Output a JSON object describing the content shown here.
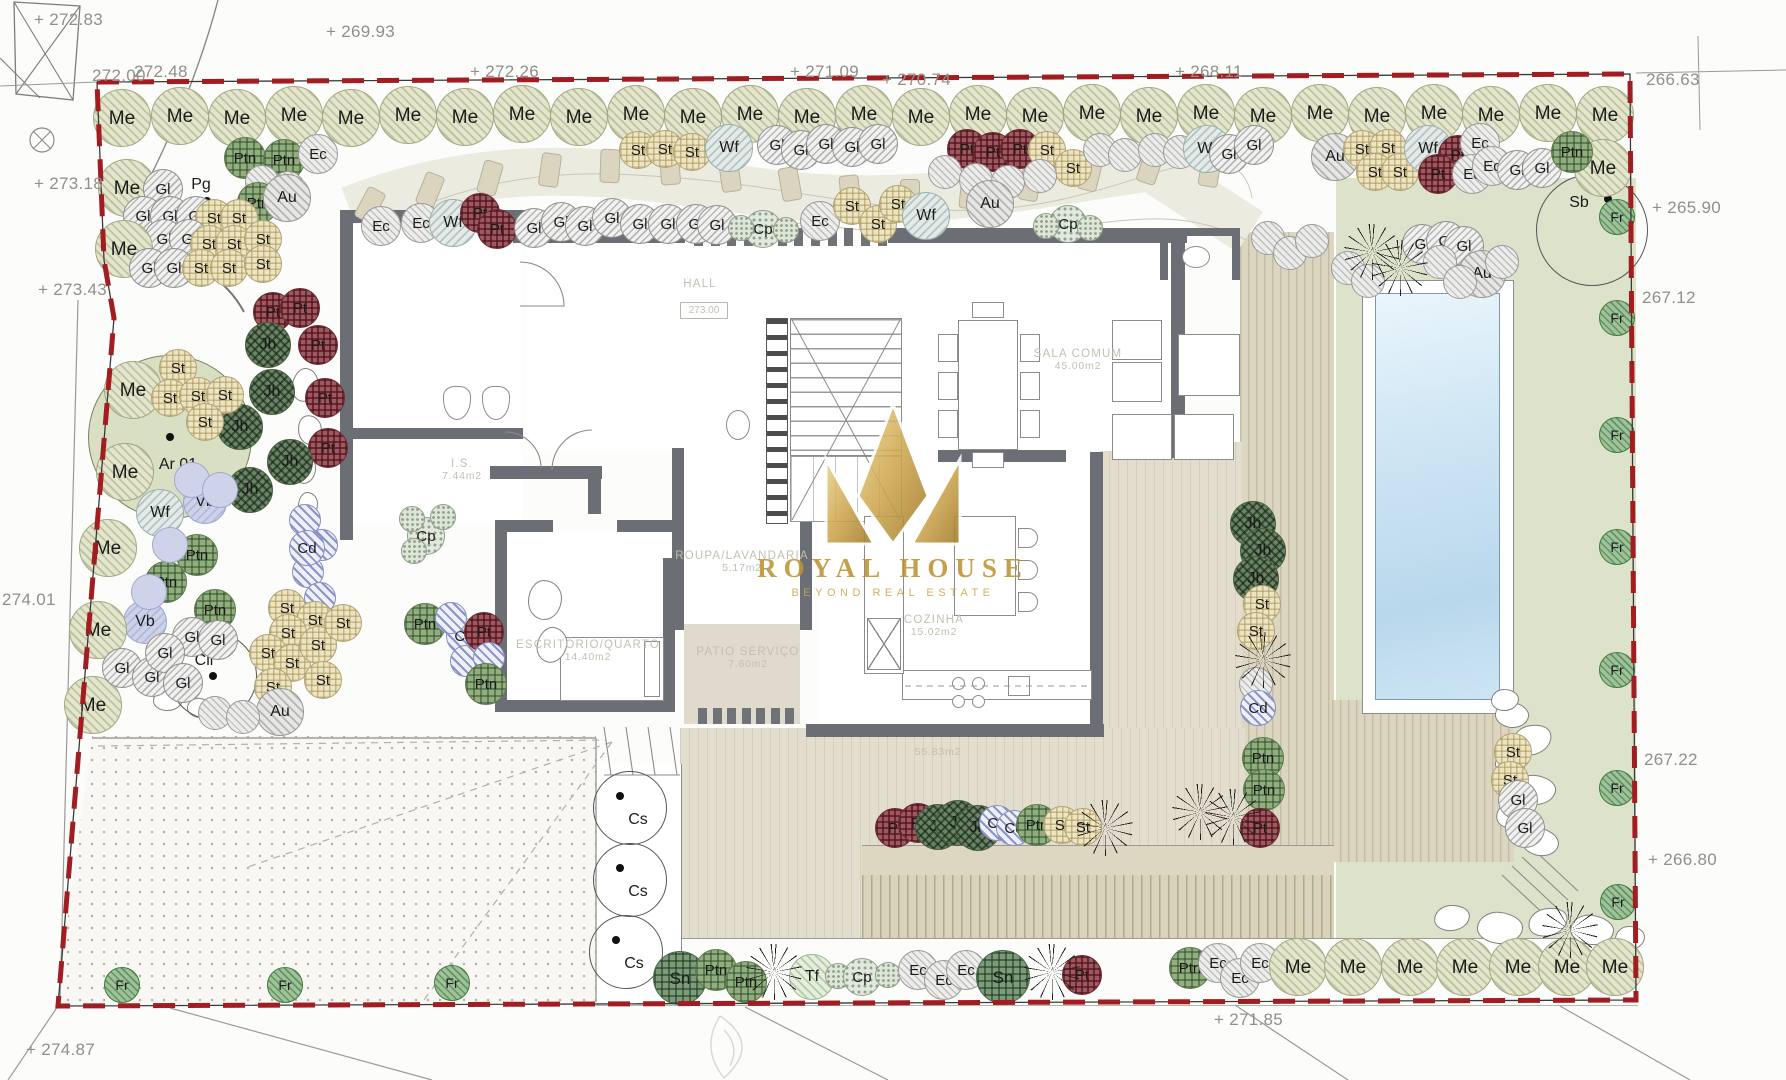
{
  "canvas": {
    "w": 1786,
    "h": 1080
  },
  "watermark": {
    "title": "ROYAL HOUSE",
    "subtitle": "BEYOND REAL ESTATE"
  },
  "rooms": [
    {
      "name": "HALL",
      "area": "",
      "level": "273.00",
      "x": 700,
      "y": 284
    },
    {
      "name": "I.S.",
      "area": "7.44m2",
      "x": 462,
      "y": 470
    },
    {
      "name": "SALA COMUM",
      "area": "45.00m2",
      "x": 1078,
      "y": 360
    },
    {
      "name": "COZINHA",
      "area": "15.02m2",
      "x": 934,
      "y": 626
    },
    {
      "name": "ROUPA/LAVANDARIA",
      "area": "5.17m2",
      "x": 742,
      "y": 562
    },
    {
      "name": "ESCRITÓRIO/QUARTO",
      "area": "14.40m2",
      "x": 588,
      "y": 651
    },
    {
      "name": "PATIO SERVIÇO",
      "area": "7.60m2",
      "x": 748,
      "y": 658
    },
    {
      "name": "",
      "area": "55.83m2",
      "x": 938,
      "y": 752
    }
  ],
  "elevations": [
    {
      "v": "272.83",
      "x": 34,
      "y": 10,
      "plus": true
    },
    {
      "v": "269.93",
      "x": 326,
      "y": 22,
      "plus": true
    },
    {
      "v": "272.00",
      "x": 92,
      "y": 66,
      "plus": false
    },
    {
      "v": "272.48",
      "x": 134,
      "y": 62,
      "plus": false
    },
    {
      "v": "272.26",
      "x": 470,
      "y": 62,
      "plus": true
    },
    {
      "v": "271.09",
      "x": 790,
      "y": 62,
      "plus": true
    },
    {
      "v": "270.74",
      "x": 882,
      "y": 70,
      "plus": true
    },
    {
      "v": "268.11",
      "x": 1175,
      "y": 62,
      "plus": true
    },
    {
      "v": "266.63",
      "x": 1646,
      "y": 70,
      "plus": false
    },
    {
      "v": "265.90",
      "x": 1652,
      "y": 198,
      "plus": true
    },
    {
      "v": "267.12",
      "x": 1642,
      "y": 288,
      "plus": false
    },
    {
      "v": "267.22",
      "x": 1644,
      "y": 750,
      "plus": false
    },
    {
      "v": "266.80",
      "x": 1648,
      "y": 850,
      "plus": true
    },
    {
      "v": "271.85",
      "x": 1214,
      "y": 1010,
      "plus": true
    },
    {
      "v": "274.87",
      "x": 26,
      "y": 1040,
      "plus": true
    },
    {
      "v": "273.18",
      "x": 34,
      "y": 174,
      "plus": true
    },
    {
      "v": "273.43",
      "x": 38,
      "y": 280,
      "plus": true
    },
    {
      "v": "274.01",
      "x": 2,
      "y": 590,
      "plus": false
    }
  ],
  "special_trees": [
    {
      "label": "Ar 01",
      "x": 170,
      "y": 437,
      "r": 82,
      "kind": "fill",
      "dot": [
        0,
        0
      ],
      "lbl": [
        8,
        28
      ]
    },
    {
      "label": "Pg",
      "x": 207,
      "y": 201,
      "r": 0,
      "kind": "point",
      "dot": [
        0,
        0
      ],
      "lbl": [
        -6,
        -16
      ]
    },
    {
      "label": "Cli",
      "x": 213,
      "y": 676,
      "r": 44,
      "kind": "outline",
      "dot": [
        0,
        0
      ],
      "lbl": [
        -9,
        -15
      ]
    },
    {
      "label": "Sb",
      "x": 1592,
      "y": 230,
      "r": 56,
      "kind": "outline",
      "dot": [
        16,
        -31
      ],
      "lbl": [
        -13,
        -27
      ]
    },
    {
      "label": "Cs",
      "x": 630,
      "y": 808,
      "r": 37,
      "kind": "outline",
      "dot": [
        -10,
        -12
      ],
      "lbl": [
        8,
        12
      ]
    },
    {
      "label": "Cs",
      "x": 630,
      "y": 880,
      "r": 37,
      "kind": "outline",
      "dot": [
        -10,
        -12
      ],
      "lbl": [
        8,
        12
      ]
    },
    {
      "label": "Cs",
      "x": 626,
      "y": 952,
      "r": 37,
      "kind": "outline",
      "dot": [
        -10,
        -12
      ],
      "lbl": [
        8,
        12
      ]
    }
  ],
  "grasses": [
    [
      1372,
      252
    ],
    [
      1400,
      268
    ],
    [
      1263,
      660
    ],
    [
      1233,
      817
    ],
    [
      1200,
      812
    ],
    [
      774,
      972
    ],
    [
      1052,
      972
    ],
    [
      1570,
      930
    ],
    [
      1105,
      828
    ]
  ],
  "plants": [
    [
      "Me",
      122,
      118
    ],
    [
      "Me",
      180,
      116
    ],
    [
      "Me",
      237,
      118
    ],
    [
      "Me",
      294,
      115
    ],
    [
      "Me",
      351,
      118
    ],
    [
      "Me",
      408,
      115
    ],
    [
      "Me",
      465,
      117
    ],
    [
      "Me",
      522,
      114
    ],
    [
      "Me",
      579,
      117
    ],
    [
      "Me",
      636,
      114
    ],
    [
      "Me",
      693,
      117
    ],
    [
      "Me",
      750,
      114
    ],
    [
      "Me",
      807,
      117
    ],
    [
      "Me",
      864,
      114
    ],
    [
      "Me",
      921,
      117
    ],
    [
      "Me",
      978,
      114
    ],
    [
      "Me",
      1035,
      116
    ],
    [
      "Me",
      1092,
      113
    ],
    [
      "Me",
      1149,
      116
    ],
    [
      "Me",
      1206,
      113
    ],
    [
      "Me",
      1263,
      116
    ],
    [
      "Me",
      1320,
      113
    ],
    [
      "Me",
      1377,
      116
    ],
    [
      "Me",
      1434,
      113
    ],
    [
      "Me",
      1491,
      115
    ],
    [
      "Me",
      1548,
      113
    ],
    [
      "Me",
      1605,
      115
    ],
    [
      "Me",
      1603,
      168
    ],
    [
      "St",
      638,
      150
    ],
    [
      "St",
      665,
      149
    ],
    [
      "St",
      692,
      152
    ],
    [
      "Wf",
      729,
      148
    ],
    [
      "Gl",
      777,
      145
    ],
    [
      "Gl",
      801,
      150
    ],
    [
      "Gl",
      826,
      144
    ],
    [
      "Gl",
      852,
      147
    ],
    [
      "Gl",
      878,
      144
    ],
    [
      "Pt",
      967,
      149
    ],
    [
      "Pt",
      993,
      152
    ],
    [
      "Pt",
      1020,
      149
    ],
    [
      "St",
      1047,
      150
    ],
    [
      "St",
      1073,
      168
    ],
    [
      "Gx",
      945,
      172
    ],
    [
      "Gx",
      976,
      180
    ],
    [
      "Gx",
      1008,
      182
    ],
    [
      "Gx",
      1040,
      176
    ],
    [
      "Gx",
      1100,
      150
    ],
    [
      "Gx",
      1125,
      155
    ],
    [
      "Gx",
      1155,
      150
    ],
    [
      "Gx",
      1180,
      152
    ],
    [
      "Wf",
      1207,
      149
    ],
    [
      "Gl",
      1229,
      154
    ],
    [
      "Gl",
      1254,
      145
    ],
    [
      "Au",
      1335,
      157
    ],
    [
      "St",
      1362,
      149
    ],
    [
      "St",
      1388,
      148
    ],
    [
      "St",
      1375,
      172
    ],
    [
      "St",
      1400,
      172
    ],
    [
      "Wf",
      1428,
      149
    ],
    [
      "Pt",
      1458,
      155
    ],
    [
      "Ec",
      1480,
      143
    ],
    [
      "Pt",
      1438,
      174
    ],
    [
      "Ec",
      1472,
      174
    ],
    [
      "Ec",
      1492,
      166
    ],
    [
      "Gl",
      1517,
      170
    ],
    [
      "Gl",
      1542,
      168
    ],
    [
      "Ptn",
      1572,
      152
    ],
    [
      "Ptn",
      245,
      158
    ],
    [
      "Ptn",
      284,
      160
    ],
    [
      "Gx",
      262,
      182
    ],
    [
      "Gx",
      288,
      188
    ],
    [
      "Ptn",
      258,
      203
    ],
    [
      "Au",
      287,
      198
    ],
    [
      "Me",
      127,
      188
    ],
    [
      "Gl",
      163,
      189
    ],
    [
      "Gl",
      143,
      216
    ],
    [
      "Gl",
      170,
      216
    ],
    [
      "Gl",
      196,
      216
    ],
    [
      "St",
      214,
      218
    ],
    [
      "St",
      239,
      218
    ],
    [
      "Gl",
      164,
      239
    ],
    [
      "Gl",
      189,
      239
    ],
    [
      "St",
      209,
      244
    ],
    [
      "St",
      234,
      244
    ],
    [
      "St",
      263,
      239
    ],
    [
      "Me",
      124,
      249
    ],
    [
      "Gl",
      149,
      268
    ],
    [
      "Gl",
      174,
      268
    ],
    [
      "St",
      201,
      268
    ],
    [
      "St",
      229,
      268
    ],
    [
      "St",
      263,
      264
    ],
    [
      "Ec",
      318,
      154
    ],
    [
      "Ec",
      381,
      226
    ],
    [
      "Ec",
      421,
      223
    ],
    [
      "Wf",
      453,
      223
    ],
    [
      "Pt",
      480,
      213
    ],
    [
      "Pt",
      497,
      229
    ],
    [
      "Gl",
      534,
      228
    ],
    [
      "Gl",
      561,
      222
    ],
    [
      "Gl",
      585,
      226
    ],
    [
      "Gl",
      612,
      218
    ],
    [
      "Gl",
      640,
      224
    ],
    [
      "Gl",
      668,
      224
    ],
    [
      "Gl",
      696,
      224
    ],
    [
      "Gl",
      717,
      225
    ],
    [
      "Cp",
      763,
      229
    ],
    [
      "Gg",
      741,
      228
    ],
    [
      "Gg",
      786,
      230
    ],
    [
      "Ec",
      820,
      221
    ],
    [
      "St",
      852,
      206
    ],
    [
      "St",
      878,
      224
    ],
    [
      "St",
      898,
      204
    ],
    [
      "Wf",
      926,
      216
    ],
    [
      "Au",
      990,
      204
    ],
    [
      "Cp",
      1068,
      224
    ],
    [
      "Gg",
      1046,
      226
    ],
    [
      "Gg",
      1090,
      228
    ],
    [
      "Gl",
      1422,
      244
    ],
    [
      "Gl",
      1446,
      241
    ],
    [
      "Gl",
      1464,
      246
    ],
    [
      "Au",
      1482,
      274
    ],
    [
      "Gx",
      1268,
      238
    ],
    [
      "Gx",
      1290,
      253
    ],
    [
      "Gx",
      1312,
      241
    ],
    [
      "Gx",
      1348,
      268
    ],
    [
      "Gx",
      1368,
      281
    ],
    [
      "Gx",
      1440,
      262
    ],
    [
      "Gx",
      1460,
      282
    ],
    [
      "Gx",
      1502,
      262
    ],
    [
      "Pt",
      273,
      312
    ],
    [
      "Pt",
      300,
      308
    ],
    [
      "Pt",
      318,
      345
    ],
    [
      "Pt",
      325,
      398
    ],
    [
      "Pt",
      328,
      448
    ],
    [
      "Jh",
      268,
      345
    ],
    [
      "Jh",
      272,
      392
    ],
    [
      "Jh",
      240,
      427
    ],
    [
      "Jh",
      250,
      490
    ],
    [
      "Jh",
      290,
      462
    ],
    [
      "Gb",
      305,
      520
    ],
    [
      "Gb",
      322,
      545
    ],
    [
      "Gb",
      308,
      572
    ],
    [
      "Gb",
      320,
      598
    ],
    [
      "Gb",
      306,
      622
    ],
    [
      "Cd",
      307,
      548
    ],
    [
      "Me",
      133,
      390
    ],
    [
      "St",
      178,
      368
    ],
    [
      "St",
      170,
      398
    ],
    [
      "St",
      198,
      396
    ],
    [
      "St",
      225,
      395
    ],
    [
      "St",
      205,
      422
    ],
    [
      "Me",
      125,
      472
    ],
    [
      "Wf",
      160,
      513
    ],
    [
      "Vb",
      205,
      502
    ],
    [
      "Gv",
      192,
      480
    ],
    [
      "Gv",
      220,
      490
    ],
    [
      "Me",
      108,
      548
    ],
    [
      "Ptn",
      197,
      555
    ],
    [
      "Ptn",
      166,
      582
    ],
    [
      "Ptn",
      215,
      610
    ],
    [
      "Vb",
      145,
      622
    ],
    [
      "Gv",
      170,
      545
    ],
    [
      "Gv",
      149,
      592
    ],
    [
      "Me",
      98,
      630
    ],
    [
      "Me",
      93,
      705
    ],
    [
      "Gl",
      192,
      637
    ],
    [
      "Gl",
      218,
      640
    ],
    [
      "Gl",
      122,
      668
    ],
    [
      "Gl",
      152,
      677
    ],
    [
      "Gl",
      165,
      653
    ],
    [
      "Gl",
      183,
      683
    ],
    [
      "St",
      287,
      608
    ],
    [
      "St",
      315,
      620
    ],
    [
      "St",
      288,
      633
    ],
    [
      "St",
      268,
      653
    ],
    [
      "St",
      292,
      663
    ],
    [
      "St",
      318,
      645
    ],
    [
      "St",
      323,
      680
    ],
    [
      "St",
      273,
      687
    ],
    [
      "St",
      343,
      623
    ],
    [
      "Au",
      280,
      712
    ],
    [
      "Gx",
      215,
      713
    ],
    [
      "Gx",
      243,
      717
    ],
    [
      "Cp",
      426,
      536
    ],
    [
      "Gg",
      412,
      519
    ],
    [
      "Gg",
      443,
      517
    ],
    [
      "Gg",
      414,
      551
    ],
    [
      "Ptn",
      425,
      624
    ],
    [
      "Cd",
      464,
      636
    ],
    [
      "Gb",
      451,
      618
    ],
    [
      "Gb",
      482,
      647
    ],
    [
      "Gb",
      466,
      661
    ],
    [
      "Pt",
      484,
      632
    ],
    [
      "Gb",
      489,
      658
    ],
    [
      "Ptn",
      486,
      684
    ],
    [
      "Jh",
      1253,
      524
    ],
    [
      "Jh",
      1263,
      551
    ],
    [
      "Jh",
      1256,
      579
    ],
    [
      "St",
      1262,
      604
    ],
    [
      "St",
      1256,
      631
    ],
    [
      "Gx",
      1256,
      684
    ],
    [
      "Cd",
      1258,
      708
    ],
    [
      "Ptn",
      1263,
      758
    ],
    [
      "Ptn",
      1264,
      790
    ],
    [
      "Pt",
      1260,
      828
    ],
    [
      "Pt",
      895,
      828
    ],
    [
      "Pt",
      918,
      823
    ],
    [
      "Jh",
      938,
      827
    ],
    [
      "Jh",
      958,
      823
    ],
    [
      "Jh",
      978,
      828
    ],
    [
      "Cd",
      997,
      823
    ],
    [
      "Cd",
      1014,
      828
    ],
    [
      "Ptn",
      1037,
      825
    ],
    [
      "St",
      1062,
      825
    ],
    [
      "St",
      1083,
      827
    ],
    [
      "Sn",
      680,
      978
    ],
    [
      "Ptn",
      716,
      970
    ],
    [
      "Ptn",
      746,
      982
    ],
    [
      "Tf",
      812,
      977
    ],
    [
      "Gg",
      838,
      976
    ],
    [
      "Cp",
      862,
      977
    ],
    [
      "Gg",
      888,
      975
    ],
    [
      "Ec",
      918,
      970
    ],
    [
      "Ec",
      944,
      980
    ],
    [
      "Ec",
      966,
      970
    ],
    [
      "Sn",
      1003,
      977
    ],
    [
      "Pt",
      1082,
      975
    ],
    [
      "Ptn",
      1190,
      968
    ],
    [
      "Ec",
      1218,
      963
    ],
    [
      "Ec",
      1240,
      978
    ],
    [
      "Ec",
      1260,
      963
    ],
    [
      "Me",
      1298,
      967
    ],
    [
      "Me",
      1353,
      967
    ],
    [
      "Me",
      1410,
      967
    ],
    [
      "Me",
      1465,
      967
    ],
    [
      "Me",
      1518,
      967
    ],
    [
      "Me",
      1567,
      967
    ],
    [
      "Me",
      1615,
      967
    ],
    [
      "St",
      1513,
      752
    ],
    [
      "St",
      1510,
      780
    ],
    [
      "Gl",
      1518,
      800
    ],
    [
      "Gl",
      1525,
      828
    ],
    [
      "Fr",
      1617,
      217
    ],
    [
      "Fr",
      1617,
      318
    ],
    [
      "Fr",
      1617,
      435
    ],
    [
      "Fr",
      1617,
      547
    ],
    [
      "Fr",
      1617,
      670
    ],
    [
      "Fr",
      1617,
      788
    ],
    [
      "Fr",
      1618,
      902
    ],
    [
      "Fr",
      122,
      985
    ],
    [
      "Fr",
      285,
      985
    ],
    [
      "Fr",
      452,
      983
    ]
  ]
}
